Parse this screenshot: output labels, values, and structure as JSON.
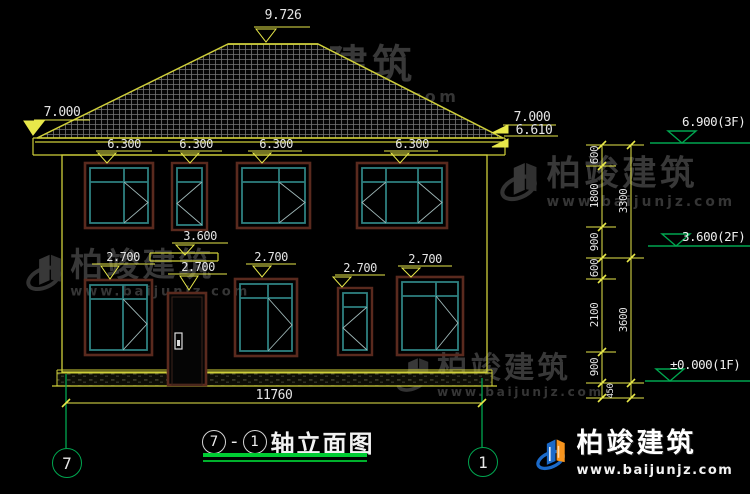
{
  "drawing": {
    "title_axis_start": "7",
    "title_dash": "-",
    "title_axis_end": "1",
    "title_text": "轴立面图",
    "axis_bubble_left": "7",
    "axis_bubble_right": "1"
  },
  "dimensions": {
    "ridge": "9.726",
    "eave_left": "7.000",
    "eave_right_top": "7.000",
    "eave_right_bottom": "6.610",
    "window_top_2f": [
      "6.300",
      "6.300",
      "6.300",
      "6.300"
    ],
    "canopy": "3.600",
    "window_top_1f": [
      "2.700",
      "2.700",
      "2.700",
      "2.700",
      "2.700"
    ],
    "total_width": "11760",
    "right_chain_inner": [
      "600",
      "1800",
      "900",
      "600",
      "2100",
      "900"
    ],
    "right_chain_outer": [
      "3300",
      "3600"
    ],
    "right_chain_bottom": "450"
  },
  "elevations": {
    "floor3": "6.900(3F)",
    "floor2": "3.600(2F)",
    "floor1": "±0.000(1F)"
  },
  "watermark": {
    "name": "柏竣建筑",
    "url": "www.baijunjz.com"
  },
  "logo": {
    "name": "柏竣建筑",
    "url": "www.baijunjz.com"
  },
  "colors": {
    "cad_line": "#cfcf3a",
    "window_frame": "#2e8080",
    "window_trim": "#5a2a1e",
    "elevation_green": "#00a650",
    "underline_green": "#00cc33",
    "logo_blue": "#1b6ac9",
    "logo_orange": "#f7941d"
  }
}
